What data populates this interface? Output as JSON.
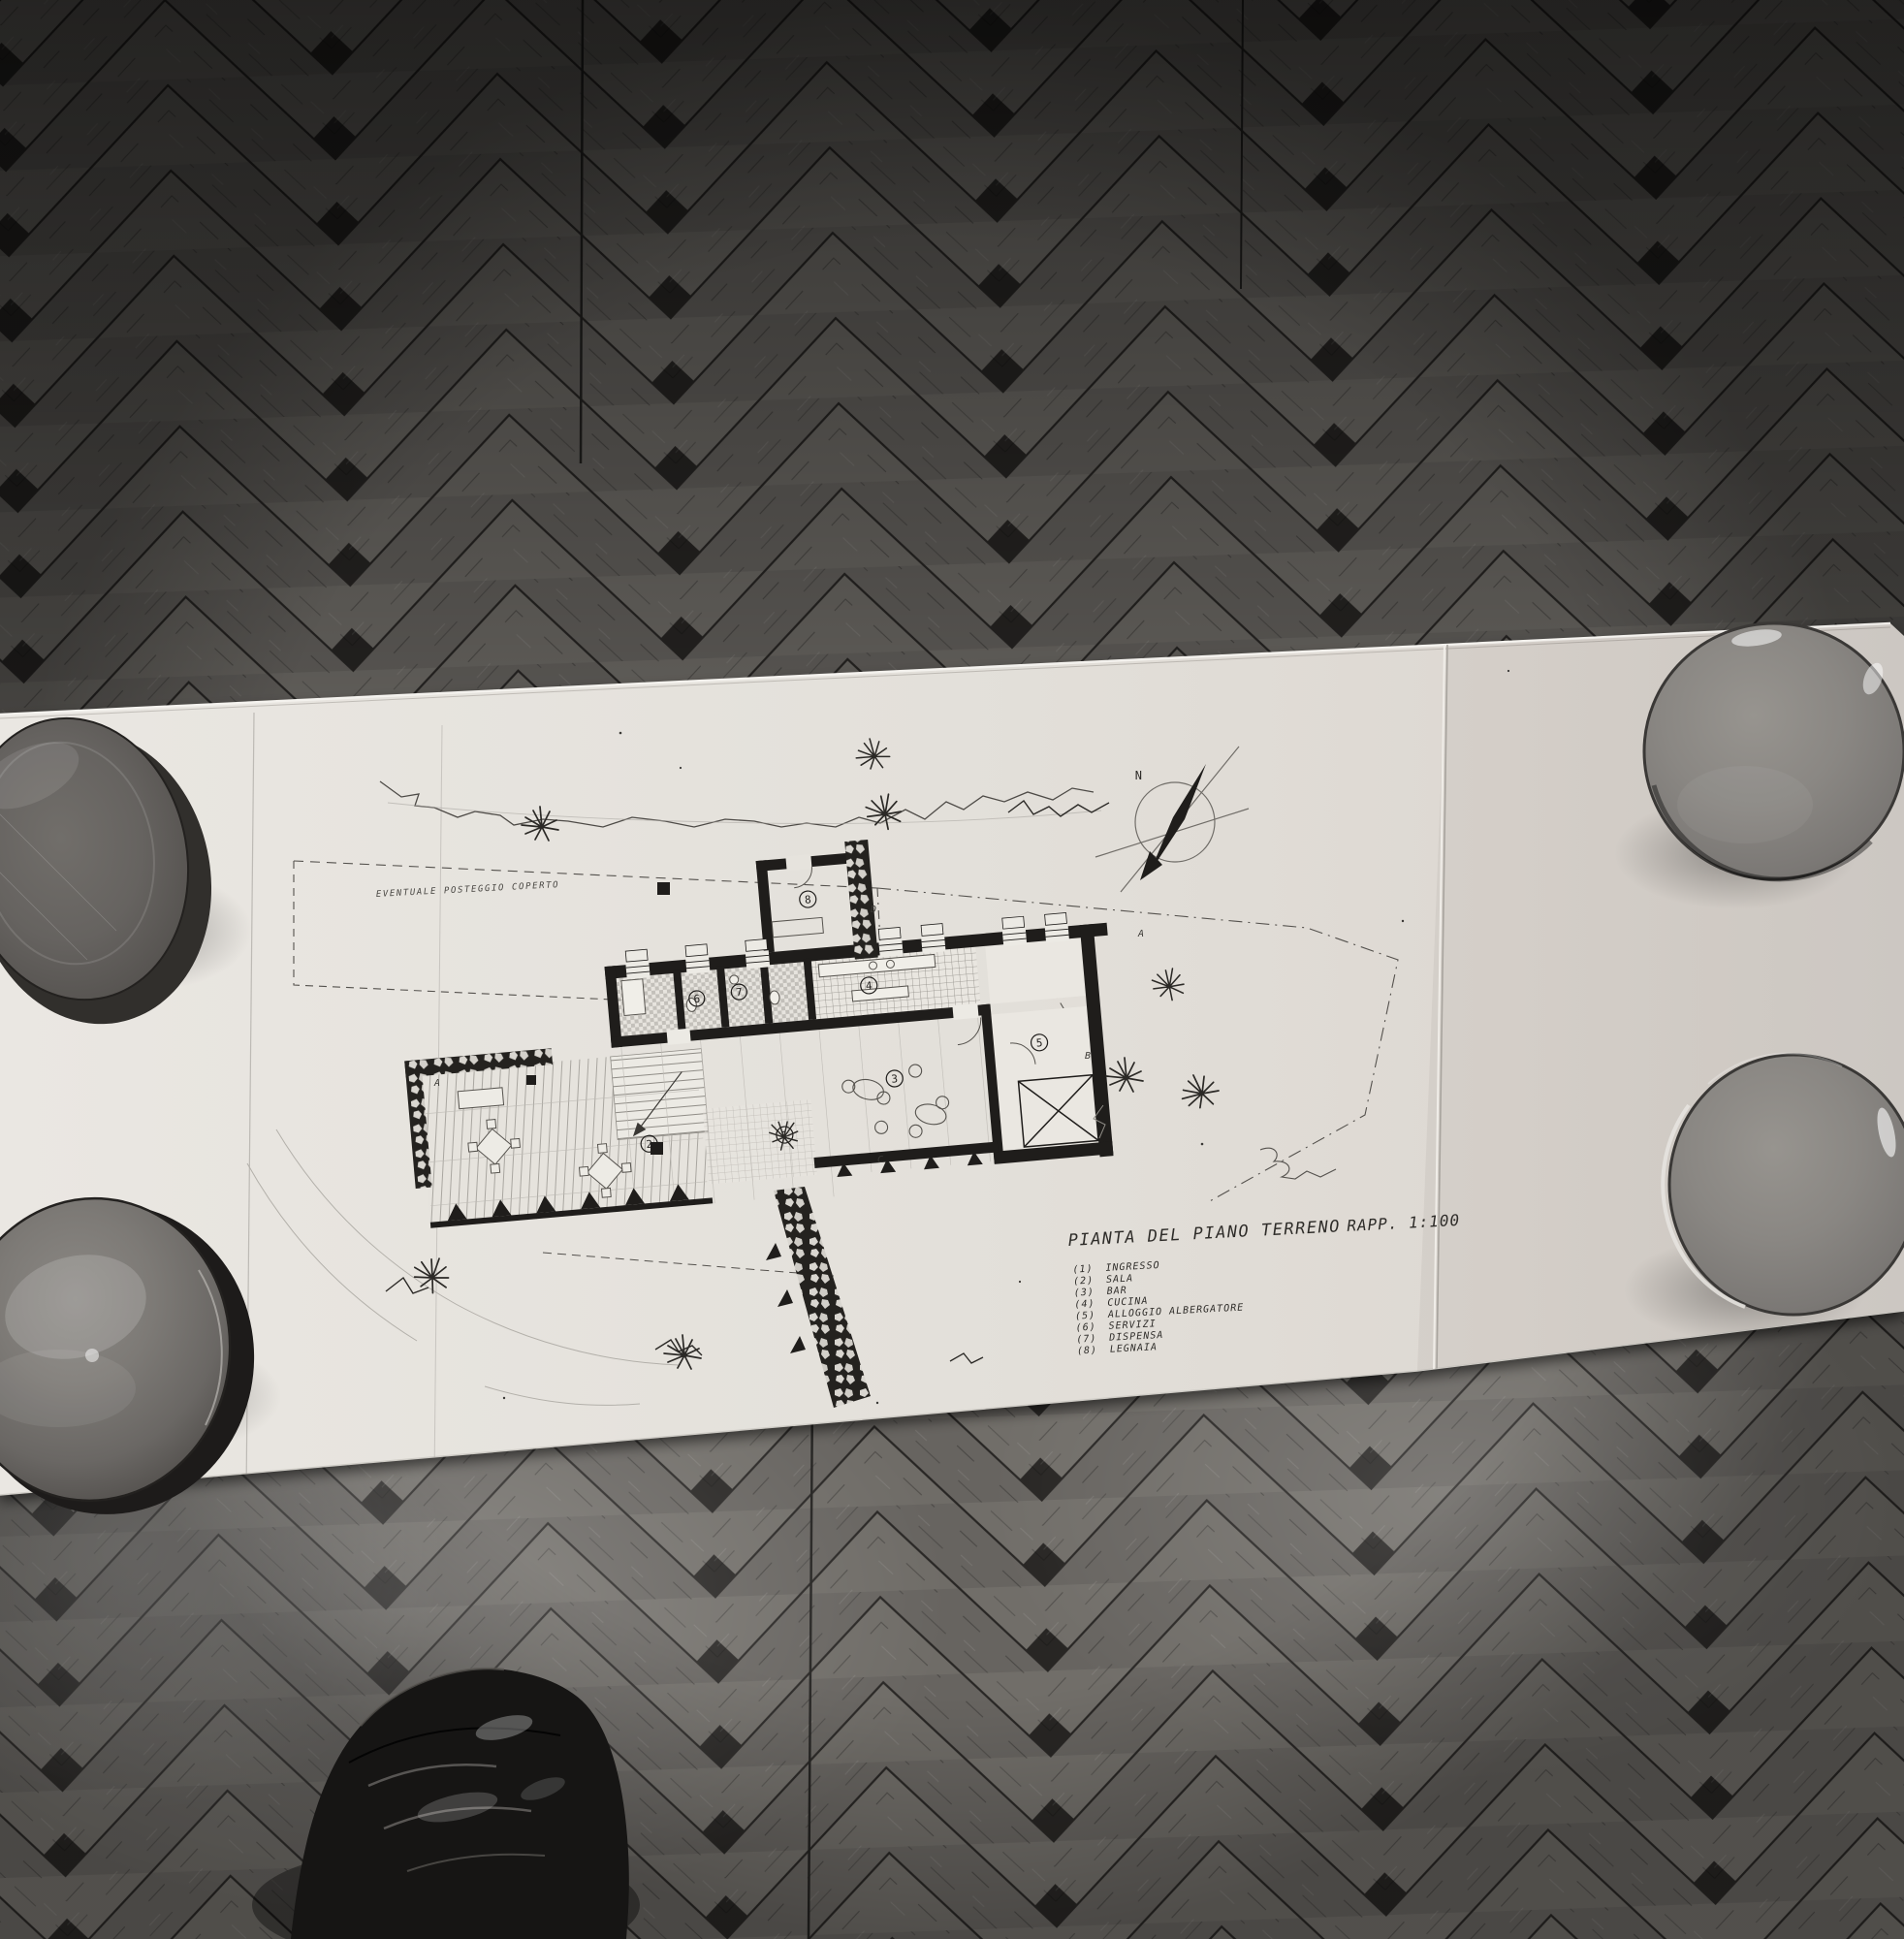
{
  "drawing": {
    "title": "PIANTA DEL PIANO TERRENO",
    "scale_label": "RAPP. 1:100",
    "parking_note": "EVENTUALE POSTEGGIO COPERTO",
    "compass_north_label": "N",
    "legend": [
      {
        "num": "(1)",
        "label": "INGRESSO"
      },
      {
        "num": "(2)",
        "label": "SALA"
      },
      {
        "num": "(3)",
        "label": "BAR"
      },
      {
        "num": "(4)",
        "label": "CUCINA"
      },
      {
        "num": "(5)",
        "label": "ALLOGGIO ALBERGATORE"
      },
      {
        "num": "(6)",
        "label": "SERVIZI"
      },
      {
        "num": "(7)",
        "label": "DISPENSA"
      },
      {
        "num": "(8)",
        "label": "LEGNAIA"
      }
    ],
    "room_labels": [
      "1",
      "2",
      "3",
      "4",
      "5",
      "6",
      "7",
      "8"
    ],
    "section_markers": [
      "A",
      "B",
      "C",
      "D"
    ]
  },
  "colors": {
    "floor_dark": "#3e3c39",
    "floor_mid": "#6c6965",
    "floor_light": "#8f8c87",
    "floor_seam": "#282624",
    "paper": "#e3e0da",
    "paper_edge_light": "#f2f0ec",
    "paper_shadow": "#161514",
    "ink": "#1f1d1b",
    "pencil": "#b3b0aa",
    "bowl_body": "#878480",
    "bowl_rim": "#3a3836",
    "bowl_highlight": "#e8e5e1",
    "plate_dark": "#504d4a",
    "shoe": "#161514"
  }
}
